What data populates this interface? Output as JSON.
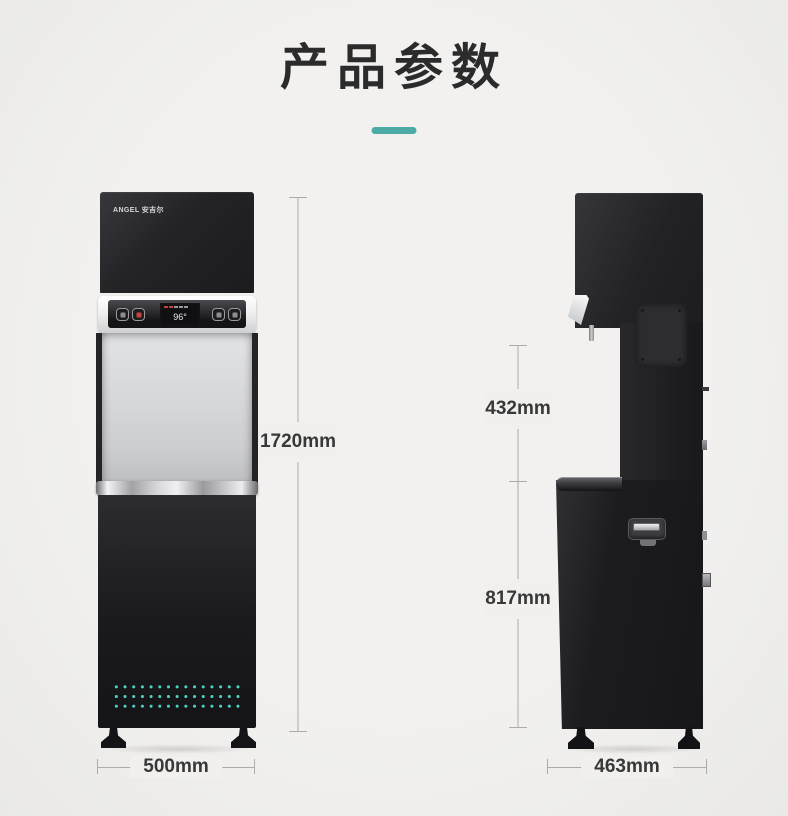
{
  "header": {
    "title": "产品参数"
  },
  "colors": {
    "background": "#f1f0ee",
    "accent_teal": "#4caca5",
    "machine_black": "#1e1e20",
    "vent_dot_teal": "#4ed2c8",
    "dimension_line_gray": "#ababab",
    "dimension_text": "#383838",
    "display_alert_red": "#c2443c"
  },
  "front_view": {
    "brand_logo": "ANGEL 安吉尔",
    "display_temperature": "96°",
    "height_label": "1720mm",
    "width_label": "500mm"
  },
  "side_view": {
    "upper_height_label": "432mm",
    "lower_height_label": "817mm",
    "depth_label": "463mm"
  }
}
